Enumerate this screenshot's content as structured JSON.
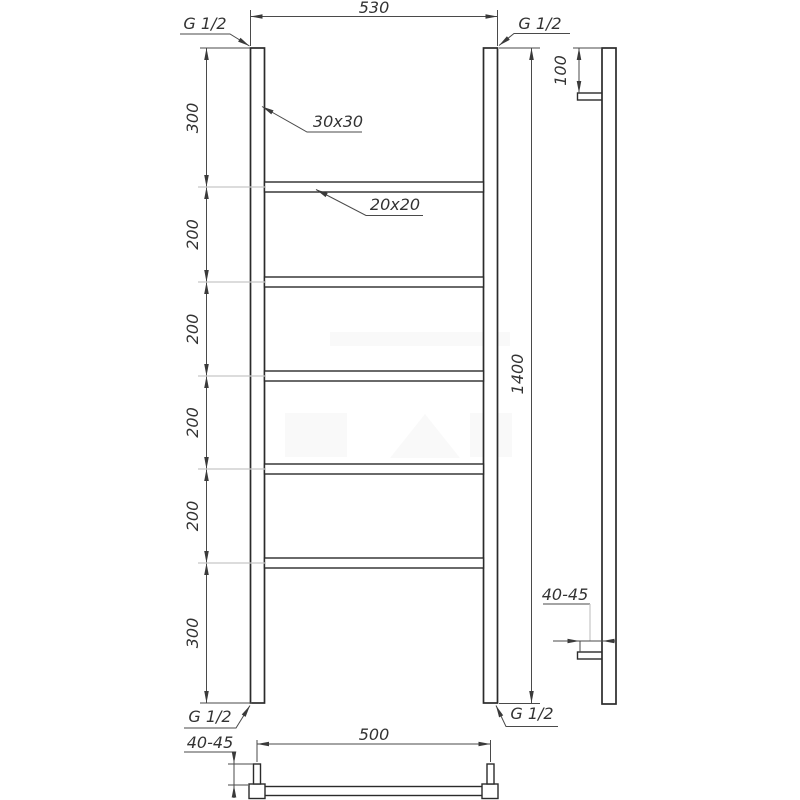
{
  "front": {
    "width_dim": "530",
    "height_dim": "1400",
    "left_dims": [
      "300",
      "200",
      "200",
      "200",
      "200",
      "300"
    ],
    "thread_top_left": "G 1/2",
    "thread_top_right": "G 1/2",
    "thread_bottom_left": "G 1/2",
    "thread_bottom_right": "G 1/2",
    "post_profile": "30x30",
    "rung_profile": "20x20"
  },
  "side": {
    "bracket_offset_dim": "100",
    "wall_clearance_dim": "40-45"
  },
  "bottom": {
    "port_spacing_dim": "500",
    "pin_height_dim": "40-45"
  },
  "colors": {
    "background": "#ffffff",
    "object_line": "#2b2b2b",
    "dimension_line": "#4a4a4a",
    "extension_line_gray": "#c6c6c6",
    "text": "#333333"
  }
}
